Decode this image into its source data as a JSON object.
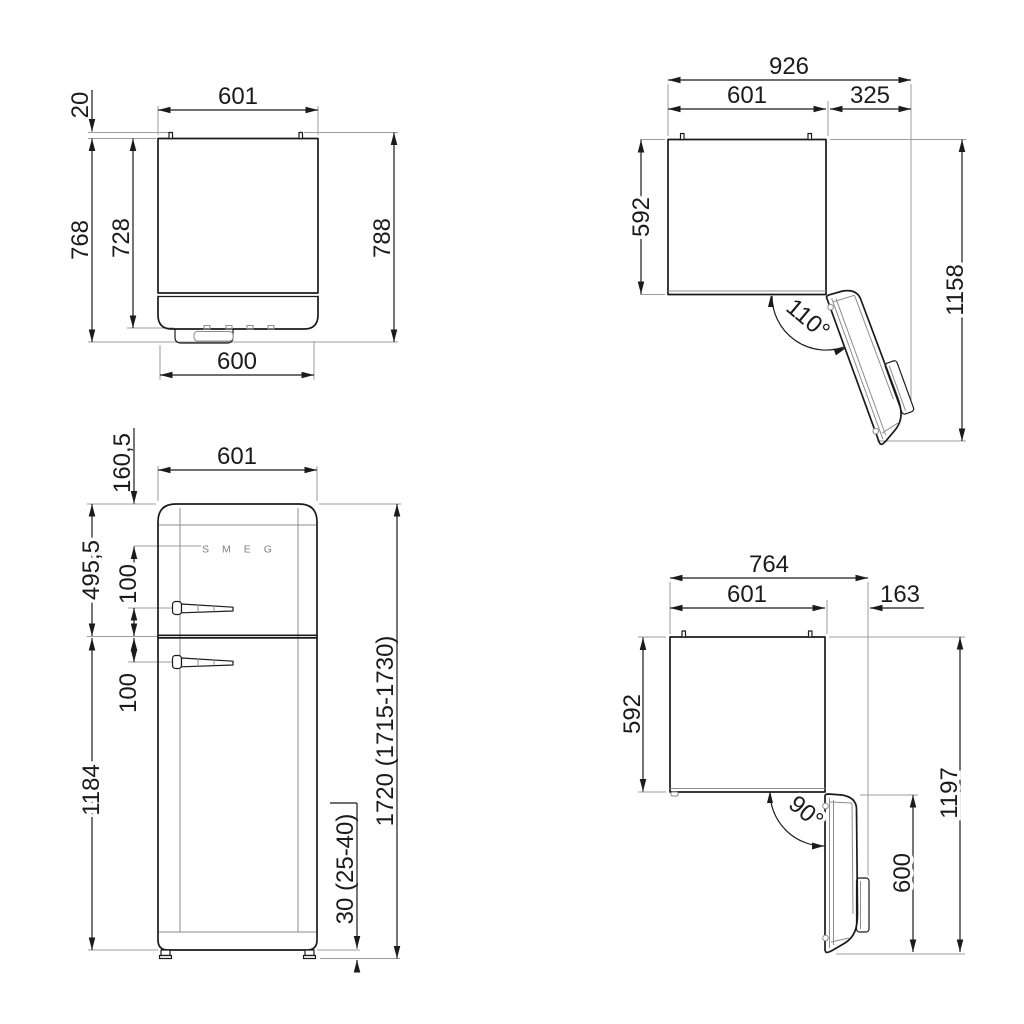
{
  "views": {
    "rear_top": {
      "pin_height": "20",
      "width": "601",
      "depth_total": "768",
      "depth_inner": "728",
      "depth_with_pins": "788",
      "width_bottom": "600"
    },
    "plan_door_110": {
      "width_total": "926",
      "width_body": "601",
      "door_swing": "325",
      "depth_body": "592",
      "depth_total": "1158",
      "angle": "110°"
    },
    "front": {
      "brand": "SMEG",
      "logo_from_top": "160,5",
      "width": "601",
      "top_to_door_split": "495,5",
      "handle_above_split": "100",
      "handle_below_split": "100",
      "lower_door_height": "1184",
      "height_total": "1720 (1715-1730)",
      "feet_height": "30 (25-40)"
    },
    "plan_door_90": {
      "width_total": "764",
      "width_body": "601",
      "door_swing": "163",
      "depth_body": "592",
      "depth_total": "1197",
      "door_width": "600",
      "angle": "90°"
    }
  }
}
